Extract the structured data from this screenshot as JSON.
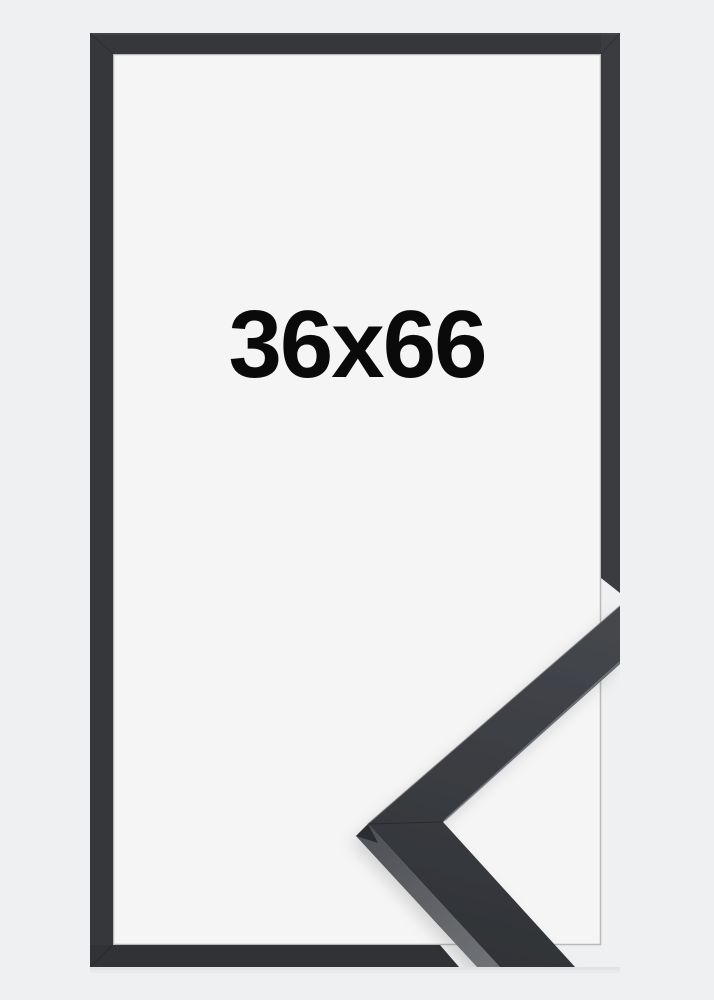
{
  "product": {
    "size_label": "36x66"
  },
  "colors": {
    "background": "#eff0f1",
    "frame_backing": "#f5f5f6",
    "frame_border": "#35373a",
    "frame_border_right": "#3a3c3f",
    "frame_border_dark": "#303236",
    "sample_face_light": "#45474c",
    "sample_face_dark": "#2f3135",
    "sample_side_light": "#6e7074",
    "sample_side_dark": "#4e5055",
    "sample_miter_face": "#2b2d30",
    "label_text": "#0a0a0a"
  }
}
